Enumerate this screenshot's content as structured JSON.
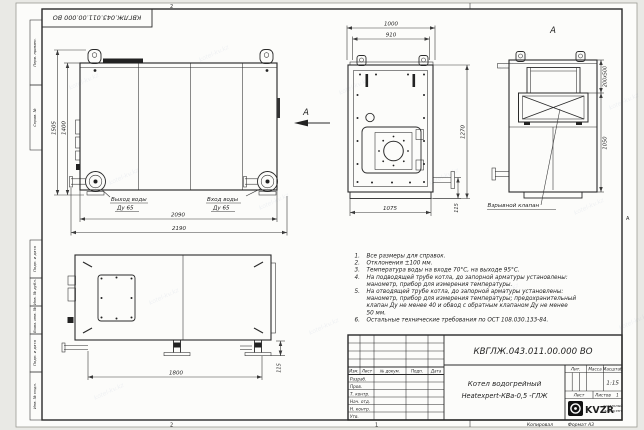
{
  "stamp": {
    "doc_number_top": "КВГЛЖ.043.011.00.000 ВО"
  },
  "frame": {
    "zone_top": "2",
    "zone_bottom_left": "2",
    "zone_bottom_right": "1",
    "zone_right": "А",
    "margin_top": [
      "Перв. примен.",
      "Справ. №"
    ],
    "margin_bottom": [
      "Подп. и дата",
      "Инв. № дубл.",
      "Взам. инв. №",
      "Подп. и дата",
      "Инв. № подл."
    ],
    "copied_label": "Копировал",
    "format_label": "Формат А3"
  },
  "views": {
    "side": {
      "dim_height_total": "1505",
      "dim_height_body": "1400",
      "dim_length_inner": "2090",
      "dim_length_total": "2190",
      "outlet_label": "Выход воды",
      "outlet_dn": "Ду 65",
      "inlet_label": "Вход воды",
      "inlet_dn": "Ду 65"
    },
    "front": {
      "arrow_label": "А",
      "dim_width_total": "1000",
      "dim_width_inner": "910",
      "dim_height": "1270",
      "dim_base_width": "1075",
      "dim_base_height": "115"
    },
    "rear": {
      "view_label": "А",
      "dim_flue": "200х500",
      "dim_height": "1050",
      "valve_label": "Взрывной клапан"
    },
    "plan": {
      "dim_legs": "1800",
      "dim_leg_height": "115"
    }
  },
  "notes": {
    "lines": [
      {
        "num": "1.",
        "text": "Все размеры для справок."
      },
      {
        "num": "2.",
        "text": "Отклонения ±100 мм."
      },
      {
        "num": "3.",
        "text": "Температура воды на входе 70°С, на выходе 95°С."
      },
      {
        "num": "4.",
        "text": "На подводящей трубе котла, до запорной арматуры установлены:"
      },
      {
        "num": "",
        "text": "манометр, прибор для измерения температуры."
      },
      {
        "num": "5.",
        "text": "На отводящей трубе котла, до запорной арматуры установлены:"
      },
      {
        "num": "",
        "text": "манометр, прибор для измерения температуры; предохранительный"
      },
      {
        "num": "",
        "text": "клапан Ду не менее 40 и обвод с обратным клапаном Ду не менее"
      },
      {
        "num": "",
        "text": "50 мм."
      },
      {
        "num": "6.",
        "text": "Остальные технические требования по ОСТ 108.030.133-84."
      }
    ]
  },
  "title_block": {
    "doc_number": "КВГЛЖ.043.011.00.000 ВО",
    "product_line1": "Котел водогрейный",
    "product_line2": "Heatexpert-КВа-0,5 -ГЛЖ",
    "cols": [
      "Изм.",
      "Лист",
      "№ докум.",
      "Подп.",
      "Дата"
    ],
    "rows": [
      "Разраб.",
      "Пров.",
      "Т. контр.",
      "Нач. отд.",
      "Н. контр.",
      "Утв."
    ],
    "lit_label": "Лит.",
    "mass_label": "Масса",
    "scale_label": "Масштаб",
    "scale_value": "1:15",
    "sheet_label": "Лист",
    "sheets_label": "Листов",
    "sheets_value": "1",
    "logo_text": "KVZR",
    "company_line1": "КОТЕЛЬНЫЙ",
    "company_line2": "ЗАВОД РЭП"
  },
  "watermark": {
    "text": "kotel-kv.kz"
  },
  "colors": {
    "paper": "#fcfcfa",
    "line": "#2a2a2a",
    "bg": "#e9e9e5"
  }
}
